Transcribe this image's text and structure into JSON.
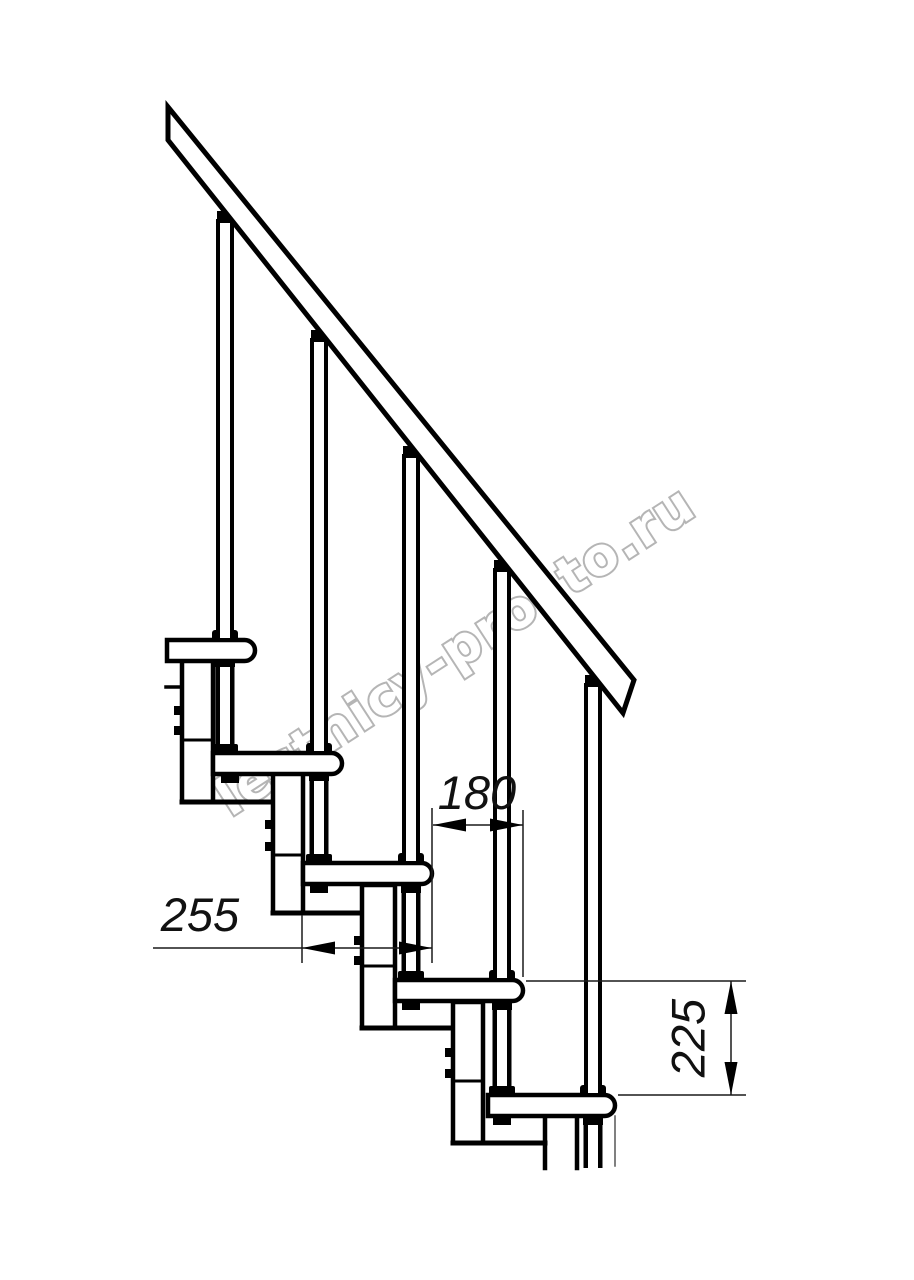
{
  "watermark": {
    "text": "lestnicy-prosto.ru",
    "color": "#b2b2b2"
  },
  "dimensions": {
    "tread_depth": "255",
    "tread_going": "180",
    "step_rise": "225"
  },
  "drawing": {
    "line_color": "#000000",
    "background_color": "#ffffff",
    "type": "staircase-side-view"
  }
}
